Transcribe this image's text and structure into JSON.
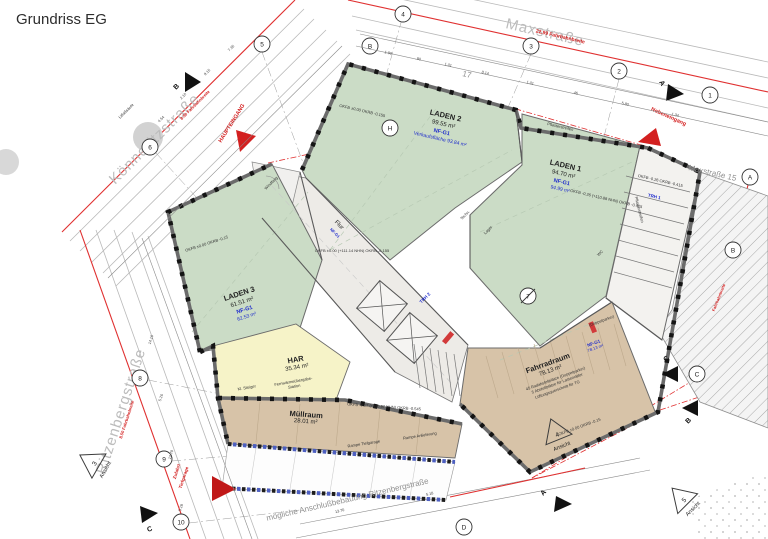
{
  "title": "Grundriss EG",
  "streets": {
    "konneritz": "Könneritzstraße",
    "max": "Maxstraße",
    "ritzenberg": "Ritzenbergstraße",
    "max15": "Maxstraße 15",
    "lot_number": "17"
  },
  "entrances": {
    "main": "HAUPTEINGANG",
    "side": "Nebeneingang",
    "garage_line1": "Zufahrt",
    "garage_line2": "Tiefgarage"
  },
  "rooms": {
    "laden1": {
      "name": "LADEN 1",
      "area": "94.70 m²",
      "nf": "NF-G1",
      "nf_area": "94.99 m²"
    },
    "laden2": {
      "name": "LADEN 2",
      "area": "99.55 m²",
      "nf": "NF-G1",
      "sales": "Verkaufsfläche 93.84 m²"
    },
    "laden3": {
      "name": "LADEN 3",
      "area": "61.51 m²",
      "nf": "NF-G1",
      "nf_area": "62.53 m²"
    },
    "har": {
      "name": "HAR",
      "area": "35.34 m²",
      "station_line1": "Fernwärmeübergabe-",
      "station_line2": "Station",
      "steiger": "Kl. Steiger"
    },
    "muellraum": {
      "name": "Müllraum",
      "area": "28.01 m²"
    },
    "fahrradraum": {
      "name": "Fahrradraum",
      "area": "78.13 m²",
      "nf": "NF-G1",
      "nf_area": "78.13 m²",
      "note1": "45 Radabstellplätze (Doppelparker)",
      "note2": "5 Abstellplätze für Lastenräder",
      "note3": "Lüftungsquerschnitt für TG",
      "doppelparker": "(Doppelparker)"
    },
    "flur": {
      "name": "Flur",
      "nf": "NF-G1"
    },
    "trh1": "TRH 1",
    "trh2": "TRH 2",
    "windfang": "Windfang",
    "lager": "Lager",
    "wc": "WC",
    "techn": "Techn."
  },
  "levels": {
    "flur": "OKFB ±0.00 (+111.14 NHN)  OKRB -0.155",
    "laden2": "OKFB ±0.00   OKRB -0.155",
    "laden3": "OKFB ±0.00   OKRB -0.15",
    "laden1": "OKFB -0.26 (+110.88 NHN)  OKRB -0.415",
    "trh1": "OKFB -0.26   OKRB -0.415",
    "muellraum": "OKFB -0.17 (+110.97 NHN)  OKRB -0.545",
    "fahrradraum": "OKFB ±0.00   OKRB -0.15"
  },
  "site": {
    "ramp": "Rampe Tiefgarage",
    "ramp2": "Rampe Anlieferung",
    "future": "mögliche Anschlußbebauung Ritzenbergstraße",
    "paving": "Pflasterstreifen",
    "column": "Litfaßsäule",
    "road_max": "22.99  Fahrbahnbreite",
    "road_konneritz": "8.50 Fahrbahnbreite",
    "road_ritzenberg": "8.50 Fahrbahnbreite",
    "road_east": "Fahrbahnbreite"
  },
  "views": {
    "v3": {
      "num": "3",
      "label": "Ansicht"
    },
    "v4": {
      "num": "4",
      "label": "Ansicht"
    },
    "v5": {
      "num": "5",
      "label": "Ansicht"
    }
  },
  "sections": {
    "a": "A",
    "b": "B",
    "c": "C"
  },
  "grid": {
    "n1": "1",
    "n2": "2",
    "n3": "3",
    "n4": "4",
    "n5": "5",
    "n6": "6",
    "n7": "7",
    "n8": "8",
    "n9": "9",
    "n10": "10",
    "lA": "A",
    "lB": "B",
    "lB2": "B",
    "lC": "C",
    "lD": "D",
    "lH": "H"
  },
  "dims": [
    "1.90",
    ".90",
    "1.01",
    "8.14",
    "1.01",
    ".46",
    "5.80",
    "1.34",
    "4.54",
    "2.10",
    "9.15",
    "7.35",
    "14.16",
    "5.26",
    "12.70",
    "5.18",
    "13.70",
    "5.18"
  ],
  "colors": {
    "shop_green": "#cbdcc6",
    "har_yellow": "#f6f3c8",
    "service_tan": "#d7c3a8",
    "corridor_gray": "#edebe7",
    "accent_red": "#d32020",
    "annotation_blue": "#1f2ccc",
    "vent_green": "#2e8b2e"
  }
}
